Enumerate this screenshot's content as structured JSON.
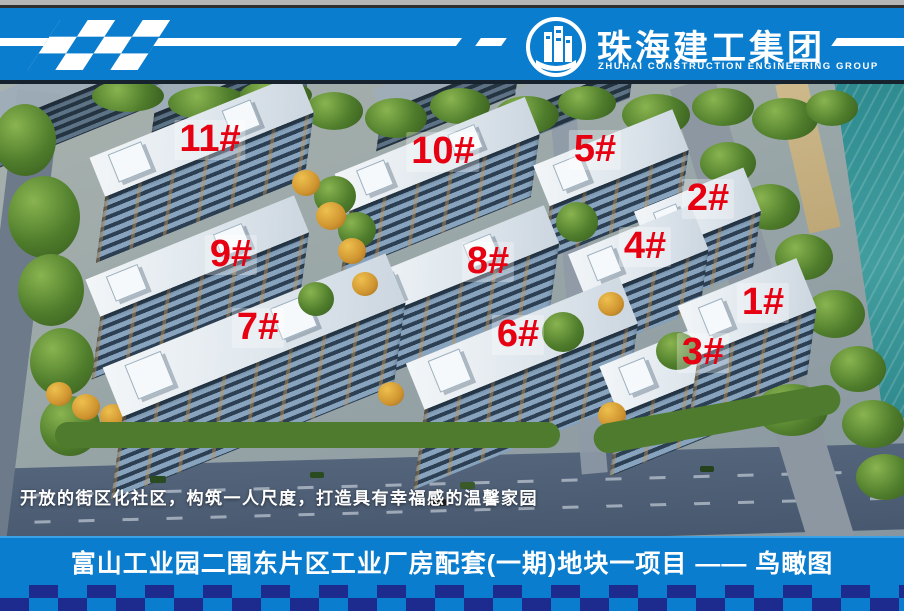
{
  "header": {
    "brand_cn": "珠海建工集团",
    "brand_en": "ZHUHAI CONSTRUCTION ENGINEERING GROUP",
    "logo_icon": "building-circle-icon",
    "flag_icon": "checkered-flag-icon"
  },
  "scene": {
    "caption": "开放的街区化社区，构筑一人尺度，打造具有幸福感的温馨家园",
    "label_color": "#e60012",
    "building_labels": [
      {
        "label": "11#",
        "x": 210,
        "y": 56
      },
      {
        "label": "10#",
        "x": 443,
        "y": 68
      },
      {
        "label": "5#",
        "x": 595,
        "y": 66
      },
      {
        "label": "2#",
        "x": 708,
        "y": 115
      },
      {
        "label": "4#",
        "x": 645,
        "y": 163
      },
      {
        "label": "9#",
        "x": 231,
        "y": 171
      },
      {
        "label": "8#",
        "x": 488,
        "y": 178
      },
      {
        "label": "1#",
        "x": 763,
        "y": 219
      },
      {
        "label": "7#",
        "x": 258,
        "y": 244
      },
      {
        "label": "6#",
        "x": 518,
        "y": 251
      },
      {
        "label": "3#",
        "x": 703,
        "y": 269
      }
    ]
  },
  "footer": {
    "title": "富山工业园二围东片区工业厂房配套(一期)地块一项目 —— 鸟瞰图"
  },
  "colors": {
    "accent_blue": "#0a7dce",
    "checker_navy": "#1e2b8e",
    "label_red": "#e60012"
  }
}
